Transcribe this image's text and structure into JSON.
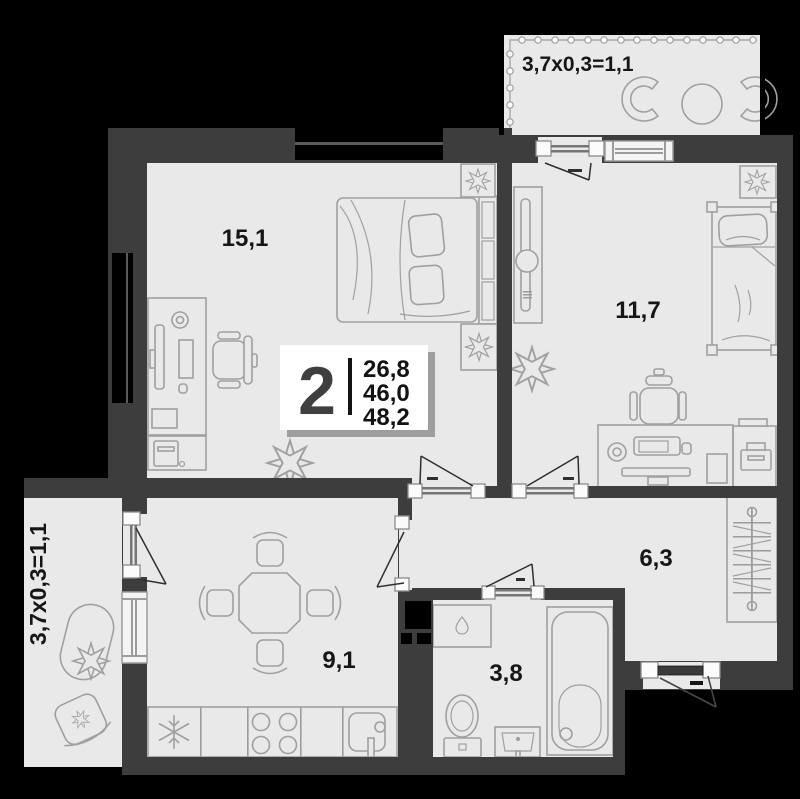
{
  "title": "2-room apartment floor plan",
  "summary": {
    "rooms_count": "2",
    "living_area": "26,8",
    "usable_area": "46,0",
    "total_area": "48,2"
  },
  "rooms": {
    "living": {
      "area": "15,1"
    },
    "bedroom": {
      "area": "11,7"
    },
    "kitchen": {
      "area": "9,1"
    },
    "bathroom": {
      "area": "3,8"
    },
    "hallway": {
      "area": "6,3"
    }
  },
  "balconies": {
    "top": {
      "dims": "3,7x0,3=1,1"
    },
    "left": {
      "dims": "3,7x0,3=1,1"
    }
  },
  "colors": {
    "background": "#000000",
    "wall": "#3d3d3d",
    "floor": "#e9e9e9",
    "furniture_stroke": "#a0a0a0",
    "label_text": "#161616",
    "info_box_bg": "#ffffff",
    "info_rooms_digit": "#3f3f3f"
  }
}
